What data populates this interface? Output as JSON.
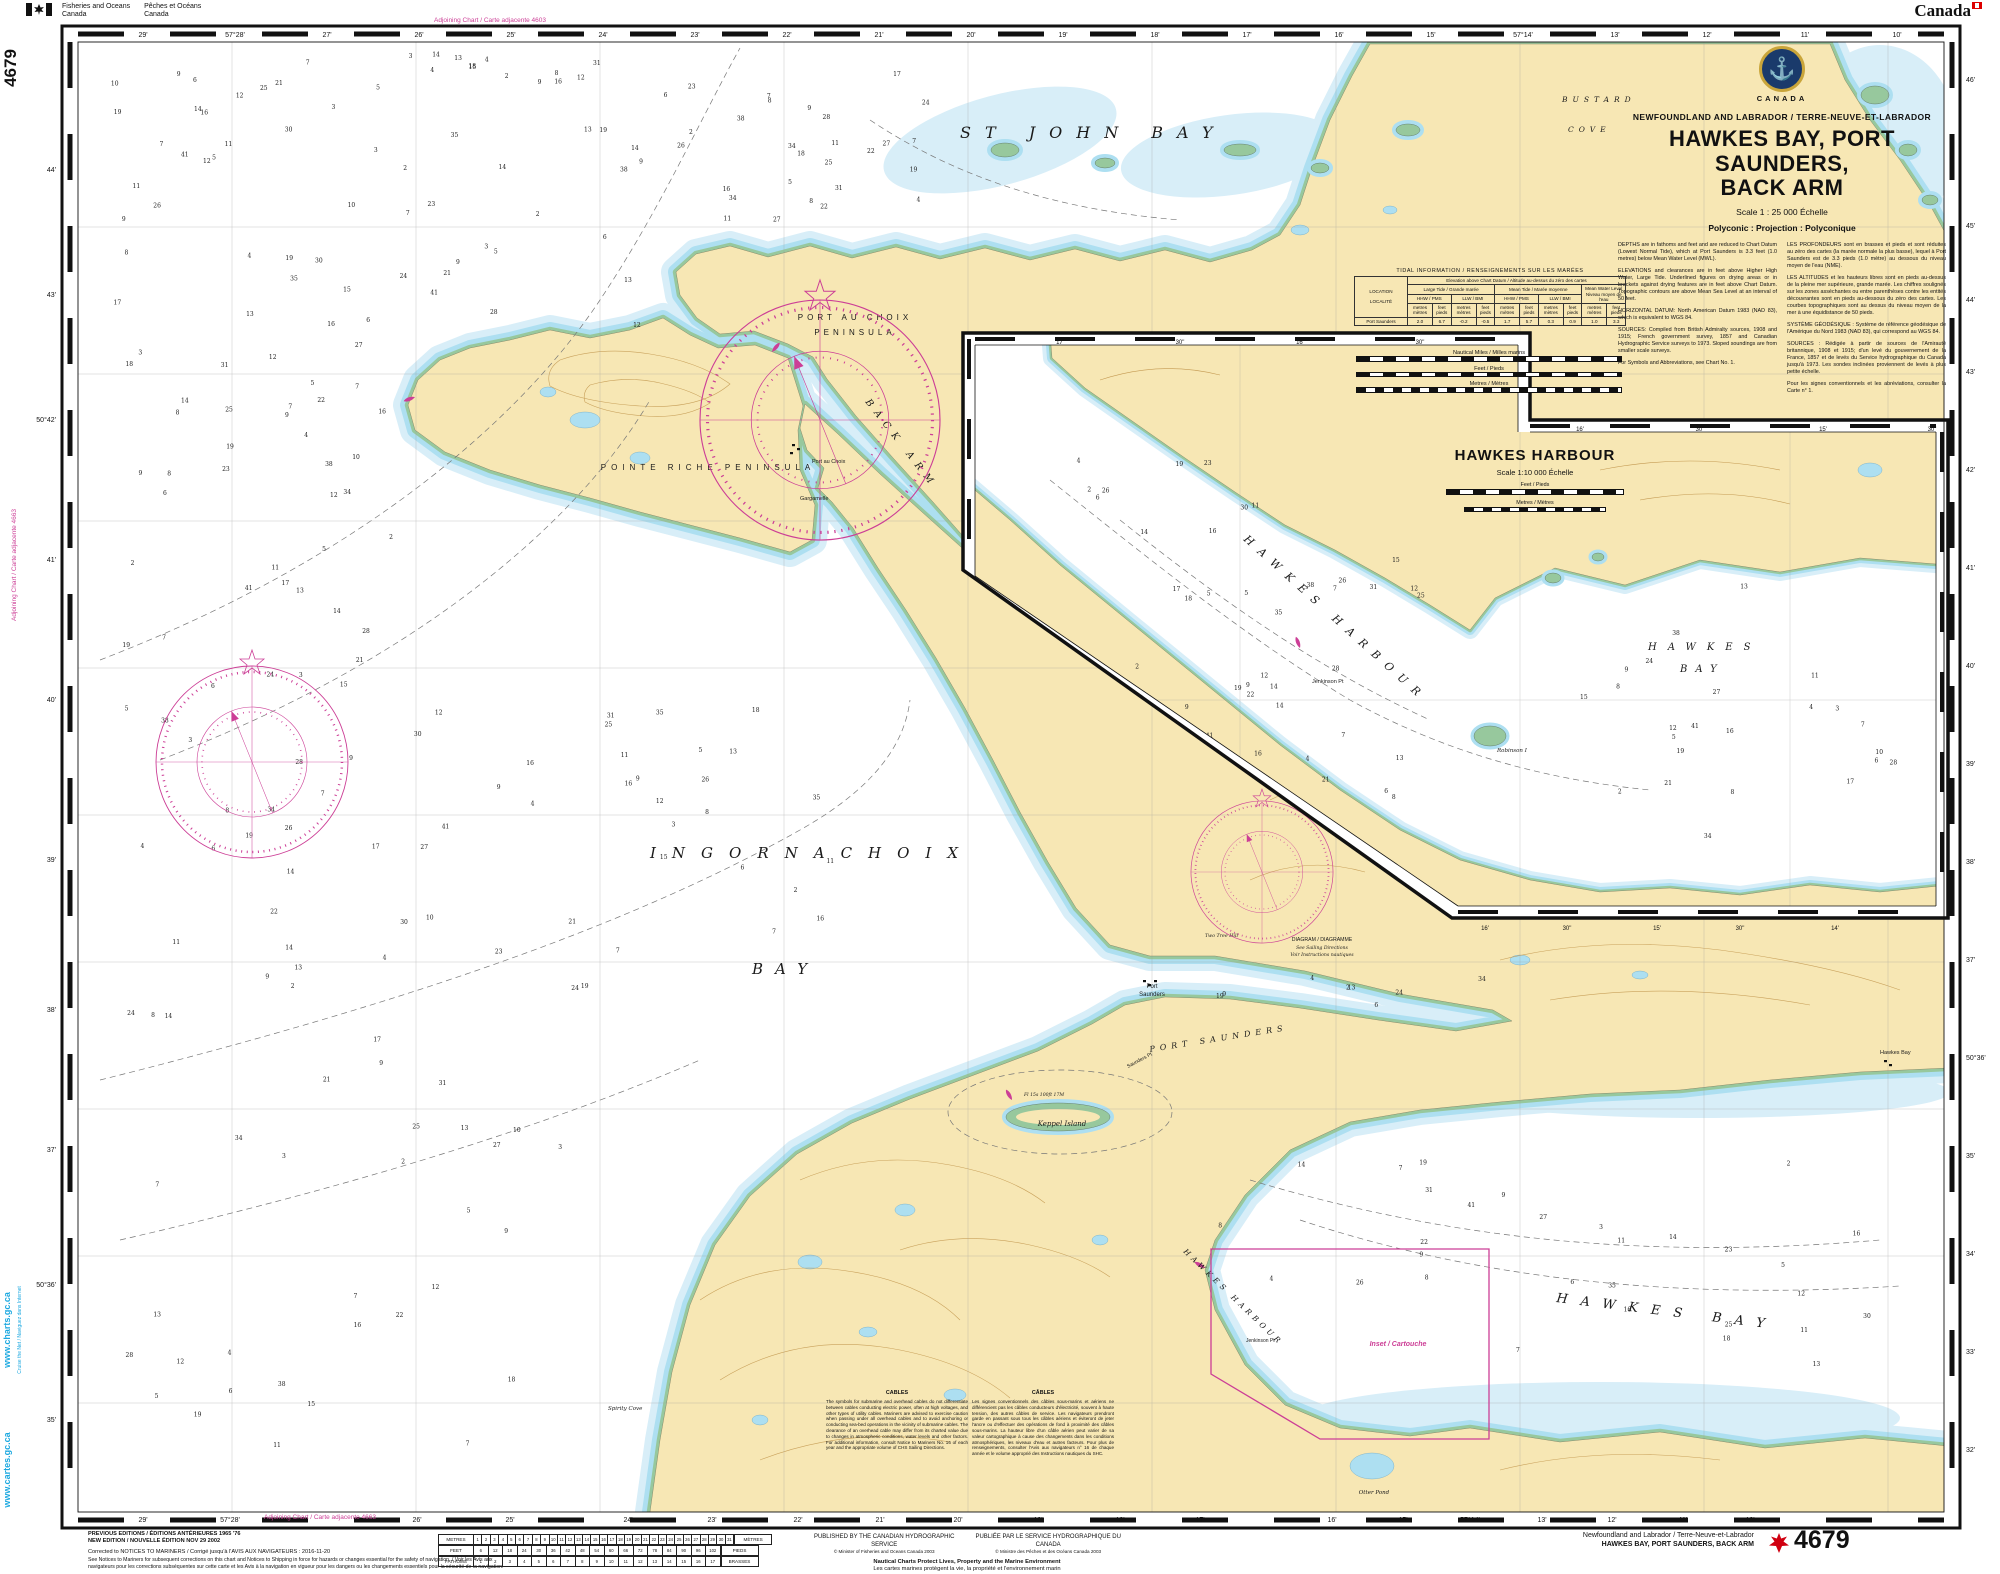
{
  "colors": {
    "land": "#F7E7B4",
    "shallow1": "#D8EEF8",
    "shallow2": "#ADDFF1",
    "foreshore": "#97C89D",
    "magenta": "#CC3E96",
    "cyan": "#1BA8E0",
    "ink": "#111111"
  },
  "margin": {
    "dept_en_1": "Fisheries and Oceans",
    "dept_en_2": "Canada",
    "dept_fr_1": "Pêches et Océans",
    "dept_fr_2": "Canada",
    "wordmark": "Canada",
    "chart_number_vertical": "4679",
    "adjoining_top": "Adjoining Chart / Carte adjacente 4603",
    "adjoining_bottom": "Adjoining Chart / Carte adjacente 4663",
    "adjoining_left": "Adjoining Chart / Carte adjacente 4663",
    "web_en": "www.charts.gc.ca",
    "web_fr": "www.cartes.gc.ca",
    "web_note": "Cruise the Net / Naviguez dans Internet"
  },
  "title_block": {
    "country": "CANADA",
    "region": "NEWFOUNDLAND AND LABRADOR / TERRE-NEUVE-ET-LABRADOR",
    "title_1": "HAWKES BAY, PORT SAUNDERS,",
    "title_2": "BACK ARM",
    "scale": "Scale 1 : 25 000 Échelle",
    "projection": "Polyconic : Projection : Polyconique",
    "en": [
      "DEPTHS are in fathoms and feet and are reduced to Chart Datum (Lowest Normal Tide), which at Port Saunders is 3.3 feet (1.0 metres) below Mean Water Level (MWL).",
      "ELEVATIONS and clearances are in feet above Higher High Water, Large Tide. Underlined figures on drying areas or in brackets against drying features are in feet above Chart Datum. Topographic contours are above Mean Sea Level at an interval of 50 feet.",
      "HORIZONTAL DATUM: North American Datum 1983 (NAD 83), which is equivalent to WGS 84.",
      "SOURCES: Compiled from British Admiralty sources, 1908 and 1915; French government survey, 1857 and Canadian Hydrographic Service surveys to 1973. Sloped soundings are from smaller scale surveys.",
      "For Symbols and Abbreviations, see Chart No. 1."
    ],
    "fr": [
      "LES PROFONDEURS sont en brasses et pieds et sont réduites au zéro des cartes (la marée normale la plus basse), lequel à Port Saunders est de 3.3 pieds (1.0 mètre) au dessous du niveau moyen de l'eau (NME).",
      "LES ALTITUDES et les hauteurs libres sont en pieds au-dessus de la pleine mer supérieure, grande marée. Les chiffres soulignés sur les zones asséchantes ou entre parenthèses contre les entités découvrantes sont en pieds au-dessous du zéro des cartes. Les courbes topographiques sont au dessus du niveau moyen de la mer à une équidistance de 50 pieds.",
      "SYSTÈME GÉODÉSIQUE : Système de référence géodésique de l'Amérique du Nord 1983 (NAD 83), qui correspond au WGS 84.",
      "SOURCES : Rédigée à partir de sources de l'Amirauté britannique, 1908 et 1915; d'un levé du gouvernement de la France, 1857 et de levés du Service hydrographique du Canada jusqu'à 1973. Les sondes inclinées proviennent de levés à plus petite échelle.",
      "Pour les signes conventionnels et les abréviations, consulter la Carte n° 1."
    ]
  },
  "tidal": {
    "title": "TIDAL INFORMATION / RENSEIGNEMENTS SUR LES MARÉES",
    "location_label": "LOCATION",
    "locality_label": "LOCALITÉ",
    "elevation_header": "Elevation above Chart Datum / Altitude au-dessus du zéro des cartes",
    "large_tide": "Large Tide / Grande marée",
    "mean_tide": "Mean Tide / Marée moyenne",
    "mwl": "Mean Water Level",
    "mwl_fr": "Niveau moyen de l'eau",
    "hhw": "HHW / PMS",
    "llw": "LLW / BMI",
    "unit_m": "metres mètres",
    "unit_ft": "feet pieds",
    "station": "Port Saunders",
    "values": [
      "2.0",
      "6.7",
      "-0.2",
      "-0.5",
      "1.7",
      "5.7",
      "0.3",
      "0.9",
      "1.0",
      "3.3"
    ]
  },
  "scalebars": {
    "nm": "Nautical Miles / Milles marins",
    "feet": "Feet / Pieds",
    "metres": "Metres / Mètres"
  },
  "inset": {
    "title": "HAWKES HARBOUR",
    "scale": "Scale 1:10 000 Échelle",
    "feet": "Feet / Pieds",
    "metres": "Metres / Mètres",
    "labels": {
      "harbour": "HAWKES HARBOUR",
      "bay1": "HAWKES",
      "bay2": "BAY",
      "jenkinson": "Jenkinson Pt",
      "robinson": "Robinson I"
    },
    "border_top": [
      {
        "t": "17'",
        "x": 1060,
        "y": 344
      },
      {
        "t": "30\"",
        "x": 1180,
        "y": 344
      },
      {
        "t": "16'",
        "x": 1300,
        "y": 344
      },
      {
        "t": "30\"",
        "x": 1420,
        "y": 344
      },
      {
        "t": "16'",
        "x": 1580,
        "y": 431
      },
      {
        "t": "30\"",
        "x": 1700,
        "y": 431
      },
      {
        "t": "15'",
        "x": 1823,
        "y": 431
      },
      {
        "t": "30\"",
        "x": 1932,
        "y": 431
      }
    ],
    "border_bottom": [
      {
        "t": "16'",
        "x": 1485,
        "y": 930
      },
      {
        "t": "30\"",
        "x": 1567,
        "y": 930
      },
      {
        "t": "15'",
        "x": 1657,
        "y": 930
      },
      {
        "t": "30\"",
        "x": 1740,
        "y": 930
      },
      {
        "t": "14'",
        "x": 1835,
        "y": 930
      }
    ]
  },
  "map_labels": {
    "water": {
      "st_john": "ST JOHN BAY",
      "ingornachoix": "INGORNACHOIX",
      "ingornachoix_bay": "BAY",
      "bustard1": "BUSTARD",
      "bustard2": "COVE",
      "back_arm": "BACK ARM",
      "port_saunders_hbr": "PORT SAUNDERS",
      "hawkes_bay": "HAWKES BAY",
      "hawkes_harbour": "HAWKES HARBOUR"
    },
    "places": {
      "pac_pen1": "PORT AU CHOIX",
      "pac_pen2": "PENINSULA",
      "pr_pen": "POINTE RICHE PENINSULA",
      "keppel": "Keppel Island",
      "port_au_choix": "Port au Choix",
      "gargamelle": "Gargamelle",
      "port": "Port",
      "saunders": "Saunders",
      "saunders_pt": "Saunders Pt",
      "jenkinson": "Jenkinson Pt",
      "spirity": "Spirity Cove",
      "otter": "Otter Pond",
      "hawkes_town": "Hawkes Bay",
      "two_tree": "Two Tree Hill",
      "light_label": "Fl 15s 100ft 17M"
    },
    "notes": {
      "inset_ref": "Inset / Cartouche",
      "diagram1": "DIAGRAM / DIAGRAMME",
      "diagram2": "See Sailing Directions",
      "diagram3": "Voir Instructions nautiques"
    }
  },
  "borders": {
    "top": [
      {
        "t": "29'",
        "x": 143
      },
      {
        "t": "57°28'",
        "x": 235
      },
      {
        "t": "27'",
        "x": 327
      },
      {
        "t": "26'",
        "x": 419
      },
      {
        "t": "25'",
        "x": 511
      },
      {
        "t": "24'",
        "x": 603
      },
      {
        "t": "23'",
        "x": 695
      },
      {
        "t": "22'",
        "x": 787
      },
      {
        "t": "21'",
        "x": 879
      },
      {
        "t": "20'",
        "x": 971
      },
      {
        "t": "19'",
        "x": 1063
      },
      {
        "t": "18'",
        "x": 1155
      },
      {
        "t": "17'",
        "x": 1247
      },
      {
        "t": "16'",
        "x": 1339
      },
      {
        "t": "15'",
        "x": 1431
      },
      {
        "t": "57°14'",
        "x": 1523
      },
      {
        "t": "13'",
        "x": 1615
      },
      {
        "t": "12'",
        "x": 1707
      },
      {
        "t": "11'",
        "x": 1805
      },
      {
        "t": "10'",
        "x": 1897
      }
    ],
    "bottom": [
      {
        "t": "29'",
        "x": 143
      },
      {
        "t": "57°28'",
        "x": 230
      },
      {
        "t": "26'",
        "x": 417
      },
      {
        "t": "25'",
        "x": 510
      },
      {
        "t": "24'",
        "x": 628
      },
      {
        "t": "23'",
        "x": 712
      },
      {
        "t": "22'",
        "x": 798
      },
      {
        "t": "21'",
        "x": 880
      },
      {
        "t": "20'",
        "x": 958
      },
      {
        "t": "19'",
        "x": 1038
      },
      {
        "t": "18'",
        "x": 1120
      },
      {
        "t": "17'",
        "x": 1200
      },
      {
        "t": "16'",
        "x": 1332
      },
      {
        "t": "15'",
        "x": 1403
      },
      {
        "t": "57°14'",
        "x": 1470
      },
      {
        "t": "13'",
        "x": 1542
      },
      {
        "t": "12'",
        "x": 1612
      },
      {
        "t": "11'",
        "x": 1683
      },
      {
        "t": "10'",
        "x": 1750
      }
    ],
    "left": [
      {
        "t": "44'",
        "y": 170
      },
      {
        "t": "43'",
        "y": 295
      },
      {
        "t": "50°42'",
        "y": 420
      },
      {
        "t": "41'",
        "y": 560
      },
      {
        "t": "40'",
        "y": 700
      },
      {
        "t": "39'",
        "y": 860
      },
      {
        "t": "38'",
        "y": 1010
      },
      {
        "t": "37'",
        "y": 1150
      },
      {
        "t": "50°36'",
        "y": 1285
      },
      {
        "t": "35'",
        "y": 1420
      }
    ],
    "right": [
      {
        "t": "46'",
        "y": 80
      },
      {
        "t": "45'",
        "y": 226
      },
      {
        "t": "44'",
        "y": 300
      },
      {
        "t": "43'",
        "y": 372
      },
      {
        "t": "42'",
        "y": 470
      },
      {
        "t": "41'",
        "y": 568
      },
      {
        "t": "40'",
        "y": 666
      },
      {
        "t": "39'",
        "y": 764
      },
      {
        "t": "38'",
        "y": 862
      },
      {
        "t": "37'",
        "y": 960
      },
      {
        "t": "50°36'",
        "y": 1058
      },
      {
        "t": "35'",
        "y": 1156
      },
      {
        "t": "34'",
        "y": 1254
      },
      {
        "t": "33'",
        "y": 1352
      },
      {
        "t": "32'",
        "y": 1450
      }
    ]
  },
  "conversion": {
    "left": [
      "METRES",
      "FEET",
      "FATHOMS"
    ],
    "right": [
      "MÈTRES",
      "PIEDS",
      "BRASSES"
    ],
    "metres": [
      1,
      2,
      3,
      4,
      5,
      6,
      7,
      8,
      9,
      10,
      11,
      12,
      13,
      14,
      15,
      16,
      17,
      18,
      19,
      20,
      21,
      22,
      23,
      24,
      25,
      26,
      27,
      28,
      29,
      30,
      31
    ],
    "feet": [
      6,
      12,
      18,
      24,
      30,
      36,
      42,
      48,
      54,
      60,
      66,
      72,
      78,
      84,
      90,
      96,
      102
    ],
    "fathoms": [
      1,
      2,
      3,
      4,
      5,
      6,
      7,
      8,
      9,
      10,
      11,
      12,
      13,
      14,
      15,
      16,
      17
    ]
  },
  "soundings": [
    7,
    12,
    3,
    18,
    25,
    9,
    14,
    31,
    5,
    22,
    8,
    16,
    27,
    11,
    4,
    19,
    34,
    6,
    13,
    2,
    24,
    9,
    15,
    38,
    7,
    21,
    10,
    3,
    17,
    28,
    5,
    12,
    41,
    8,
    23,
    14,
    6,
    19,
    2,
    30,
    11,
    26,
    4,
    16,
    9,
    35,
    13,
    7
  ],
  "notes": {
    "cables_title_en": "CABLES",
    "cables_en": "The symbols for submarine and overhead cables do not differentiate between cables conducting electric power, often at high voltages, and other types of utility cables. Mariners are advised to exercise caution when passing under all overhead cables and to avoid anchoring or conducting sea-bed operations in the vicinity of submarine cables. The clearance of an overhead cable may differ from its charted value due to changes in atmospheric conditions, water levels and other factors. For additional information, consult Notice to Mariners No. 16 of each year and the appropriate volume of CHS Sailing Directions.",
    "cables_title_fr": "CÂBLES",
    "cables_fr": "Les signes conventionnels des câbles sous-marins et aériens ne différencient pas les câbles conducteurs d'électricité, souvent à haute tension, des autres câbles de service. Les navigateurs prendront garde en passant sous tous les câbles aériens et éviteront de jeter l'ancre ou d'effectuer des opérations de fond à proximité des câbles sous-marins. La hauteur libre d'un câble aérien peut varier de sa valeur cartographique à cause des changements dans les conditions atmosphériques, les niveaux d'eau et autres facteurs. Pour plus de renseignements, consulter l'Avis aux navigateurs n° 16 de chaque année et le volume approprié des Instructions nautiques du SHC."
  },
  "footer": {
    "previous": "PREVIOUS EDITIONS / ÉDITIONS ANTÉRIEURES 1965 '76",
    "new_edition": "NEW EDITION / NOUVELLE ÉDITION NOV 29 2002",
    "corrected": "Corrected to NOTICES TO MARINERS / Corrigé jusqu'à l'AVIS AUX NAVIGATEURS :  2016-11-20",
    "fine_print": "See Notices to Mariners for subsequent corrections on this chart and Notices to Shipping in force for hazards or changes essential for the safety of navigation. / Voir les Avis aux navigateurs pour les corrections subséquentes sur cette carte et les Avis à la navigation en vigueur pour les dangers ou les changements essentiels pour la sécurité de la navigation.",
    "published_en": "PUBLISHED BY THE CANADIAN HYDROGRAPHIC SERVICE",
    "copyright_en": "© Minister of Fisheries and Oceans Canada 2003",
    "published_fr": "PUBLIÉE PAR LE SERVICE HYDROGRAPHIQUE DU CANADA",
    "copyright_fr": "© Ministre des Pêches et des Océans Canada 2003",
    "motto_en": "Nautical Charts Protect Lives, Property and the Marine Environment",
    "motto_fr": "Les cartes marines protègent la vie, la propriété et l'environnement marin",
    "region": "Newfoundland and Labrador / Terre-Neuve-et-Labrador",
    "chart_title": "HAWKES BAY, PORT SAUNDERS, BACK ARM",
    "chart_number": "4679"
  }
}
